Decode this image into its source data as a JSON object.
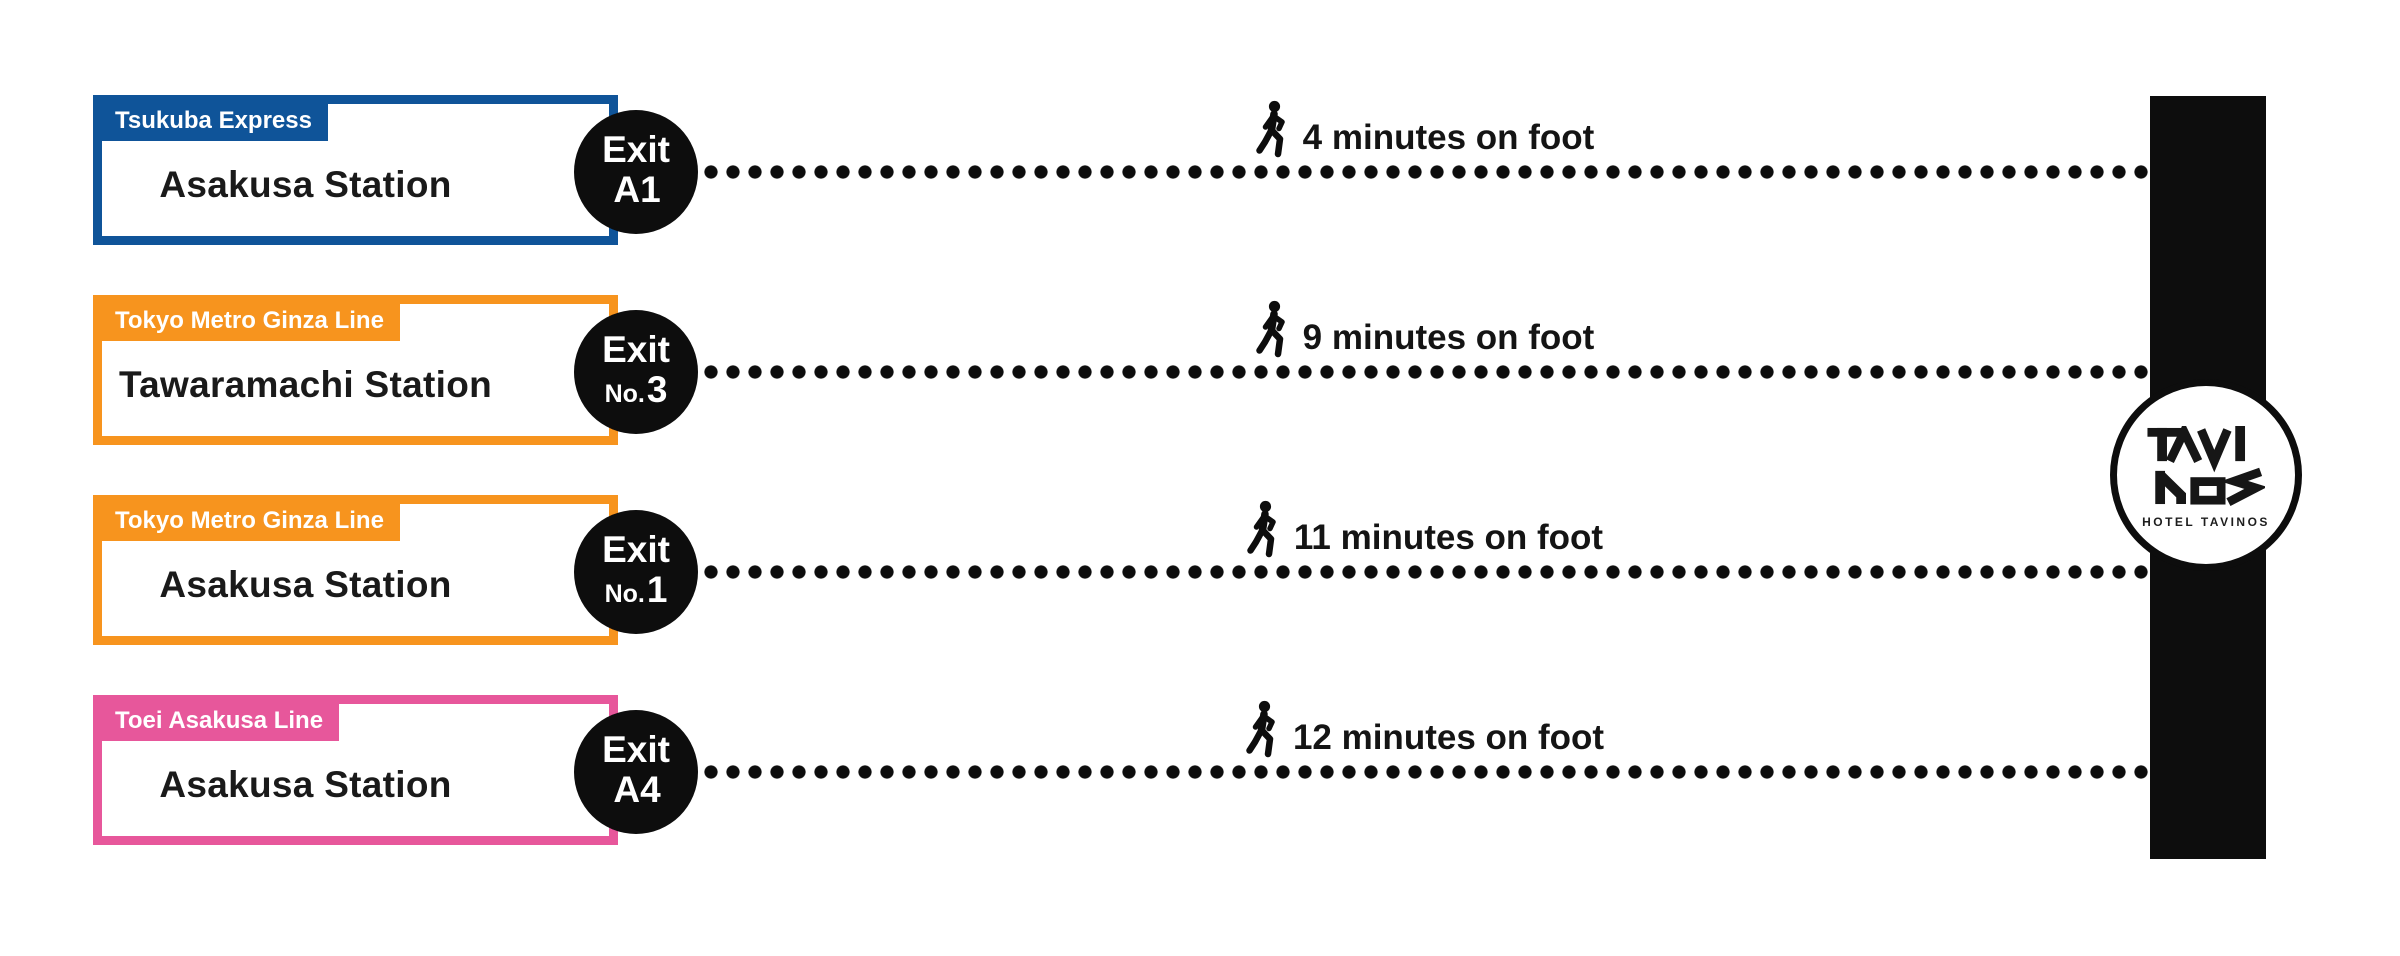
{
  "canvas": {
    "width": 2400,
    "height": 956,
    "background": "#FFFFFF"
  },
  "colors": {
    "ink": "#0D0D0D",
    "text": "#1A1A1A",
    "white": "#FFFFFF"
  },
  "hotel": {
    "bar_color": "#0D0D0D",
    "logo_text": "TAVI NOS",
    "caption": "HOTEL TAVINOS"
  },
  "routes": [
    {
      "line": "Tsukuba Express",
      "color": "#0F5499",
      "station": "Asakusa Station",
      "exit_word": "Exit",
      "exit_prefix": "",
      "exit_code": "A1",
      "walk": "4 minutes on foot"
    },
    {
      "line": "Tokyo Metro Ginza Line",
      "color": "#F7941E",
      "station": "Tawaramachi Station",
      "exit_word": "Exit",
      "exit_prefix": "No.",
      "exit_code": "3",
      "walk": "9 minutes on foot"
    },
    {
      "line": "Tokyo Metro Ginza Line",
      "color": "#F7941E",
      "station": "Asakusa Station",
      "exit_word": "Exit",
      "exit_prefix": "No.",
      "exit_code": "1",
      "walk": "11 minutes on foot"
    },
    {
      "line": "Toei Asakusa Line",
      "color": "#E7579B",
      "station": "Asakusa Station",
      "exit_word": "Exit",
      "exit_prefix": "",
      "exit_code": "A4",
      "walk": "12 minutes on foot"
    }
  ]
}
